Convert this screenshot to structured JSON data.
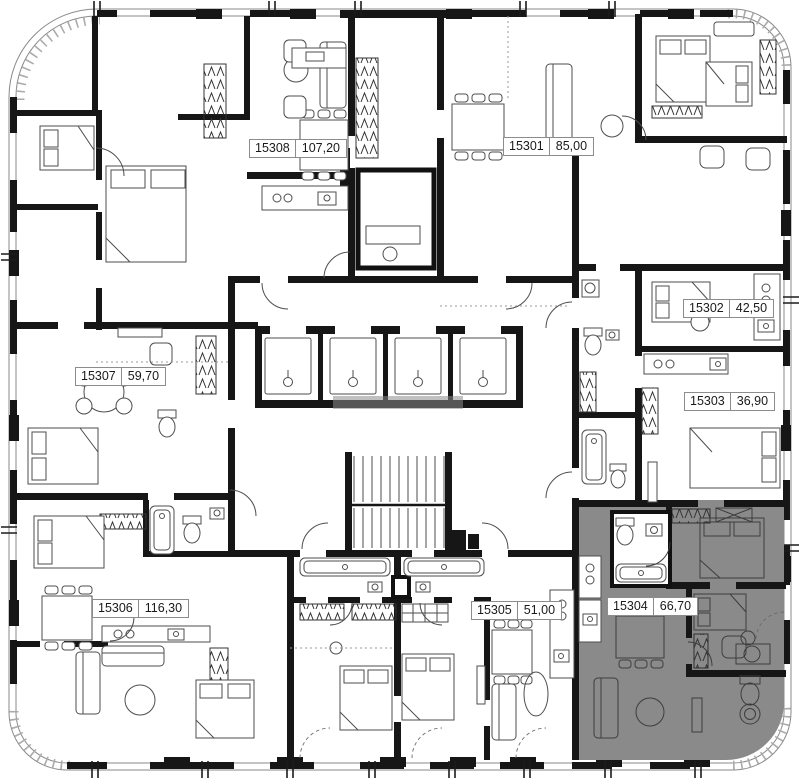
{
  "apartments": [
    {
      "number": "15308",
      "area": "107,20",
      "highlighted": false
    },
    {
      "number": "15301",
      "area": "85,00",
      "highlighted": false
    },
    {
      "number": "15302",
      "area": "42,50",
      "highlighted": false
    },
    {
      "number": "15303",
      "area": "36,90",
      "highlighted": false
    },
    {
      "number": "15304",
      "area": "66,70",
      "highlighted": true
    },
    {
      "number": "15305",
      "area": "51,00",
      "highlighted": false
    },
    {
      "number": "15306",
      "area": "116,30",
      "highlighted": false
    },
    {
      "number": "15307",
      "area": "59,70",
      "highlighted": false
    }
  ],
  "colors": {
    "wall": "#161616",
    "line": "#4d4d4d",
    "highlight_fill": "#8a8a8a",
    "label_border": "#8c8c8c",
    "label_text": "#1a1a1a",
    "background": "#ffffff"
  }
}
